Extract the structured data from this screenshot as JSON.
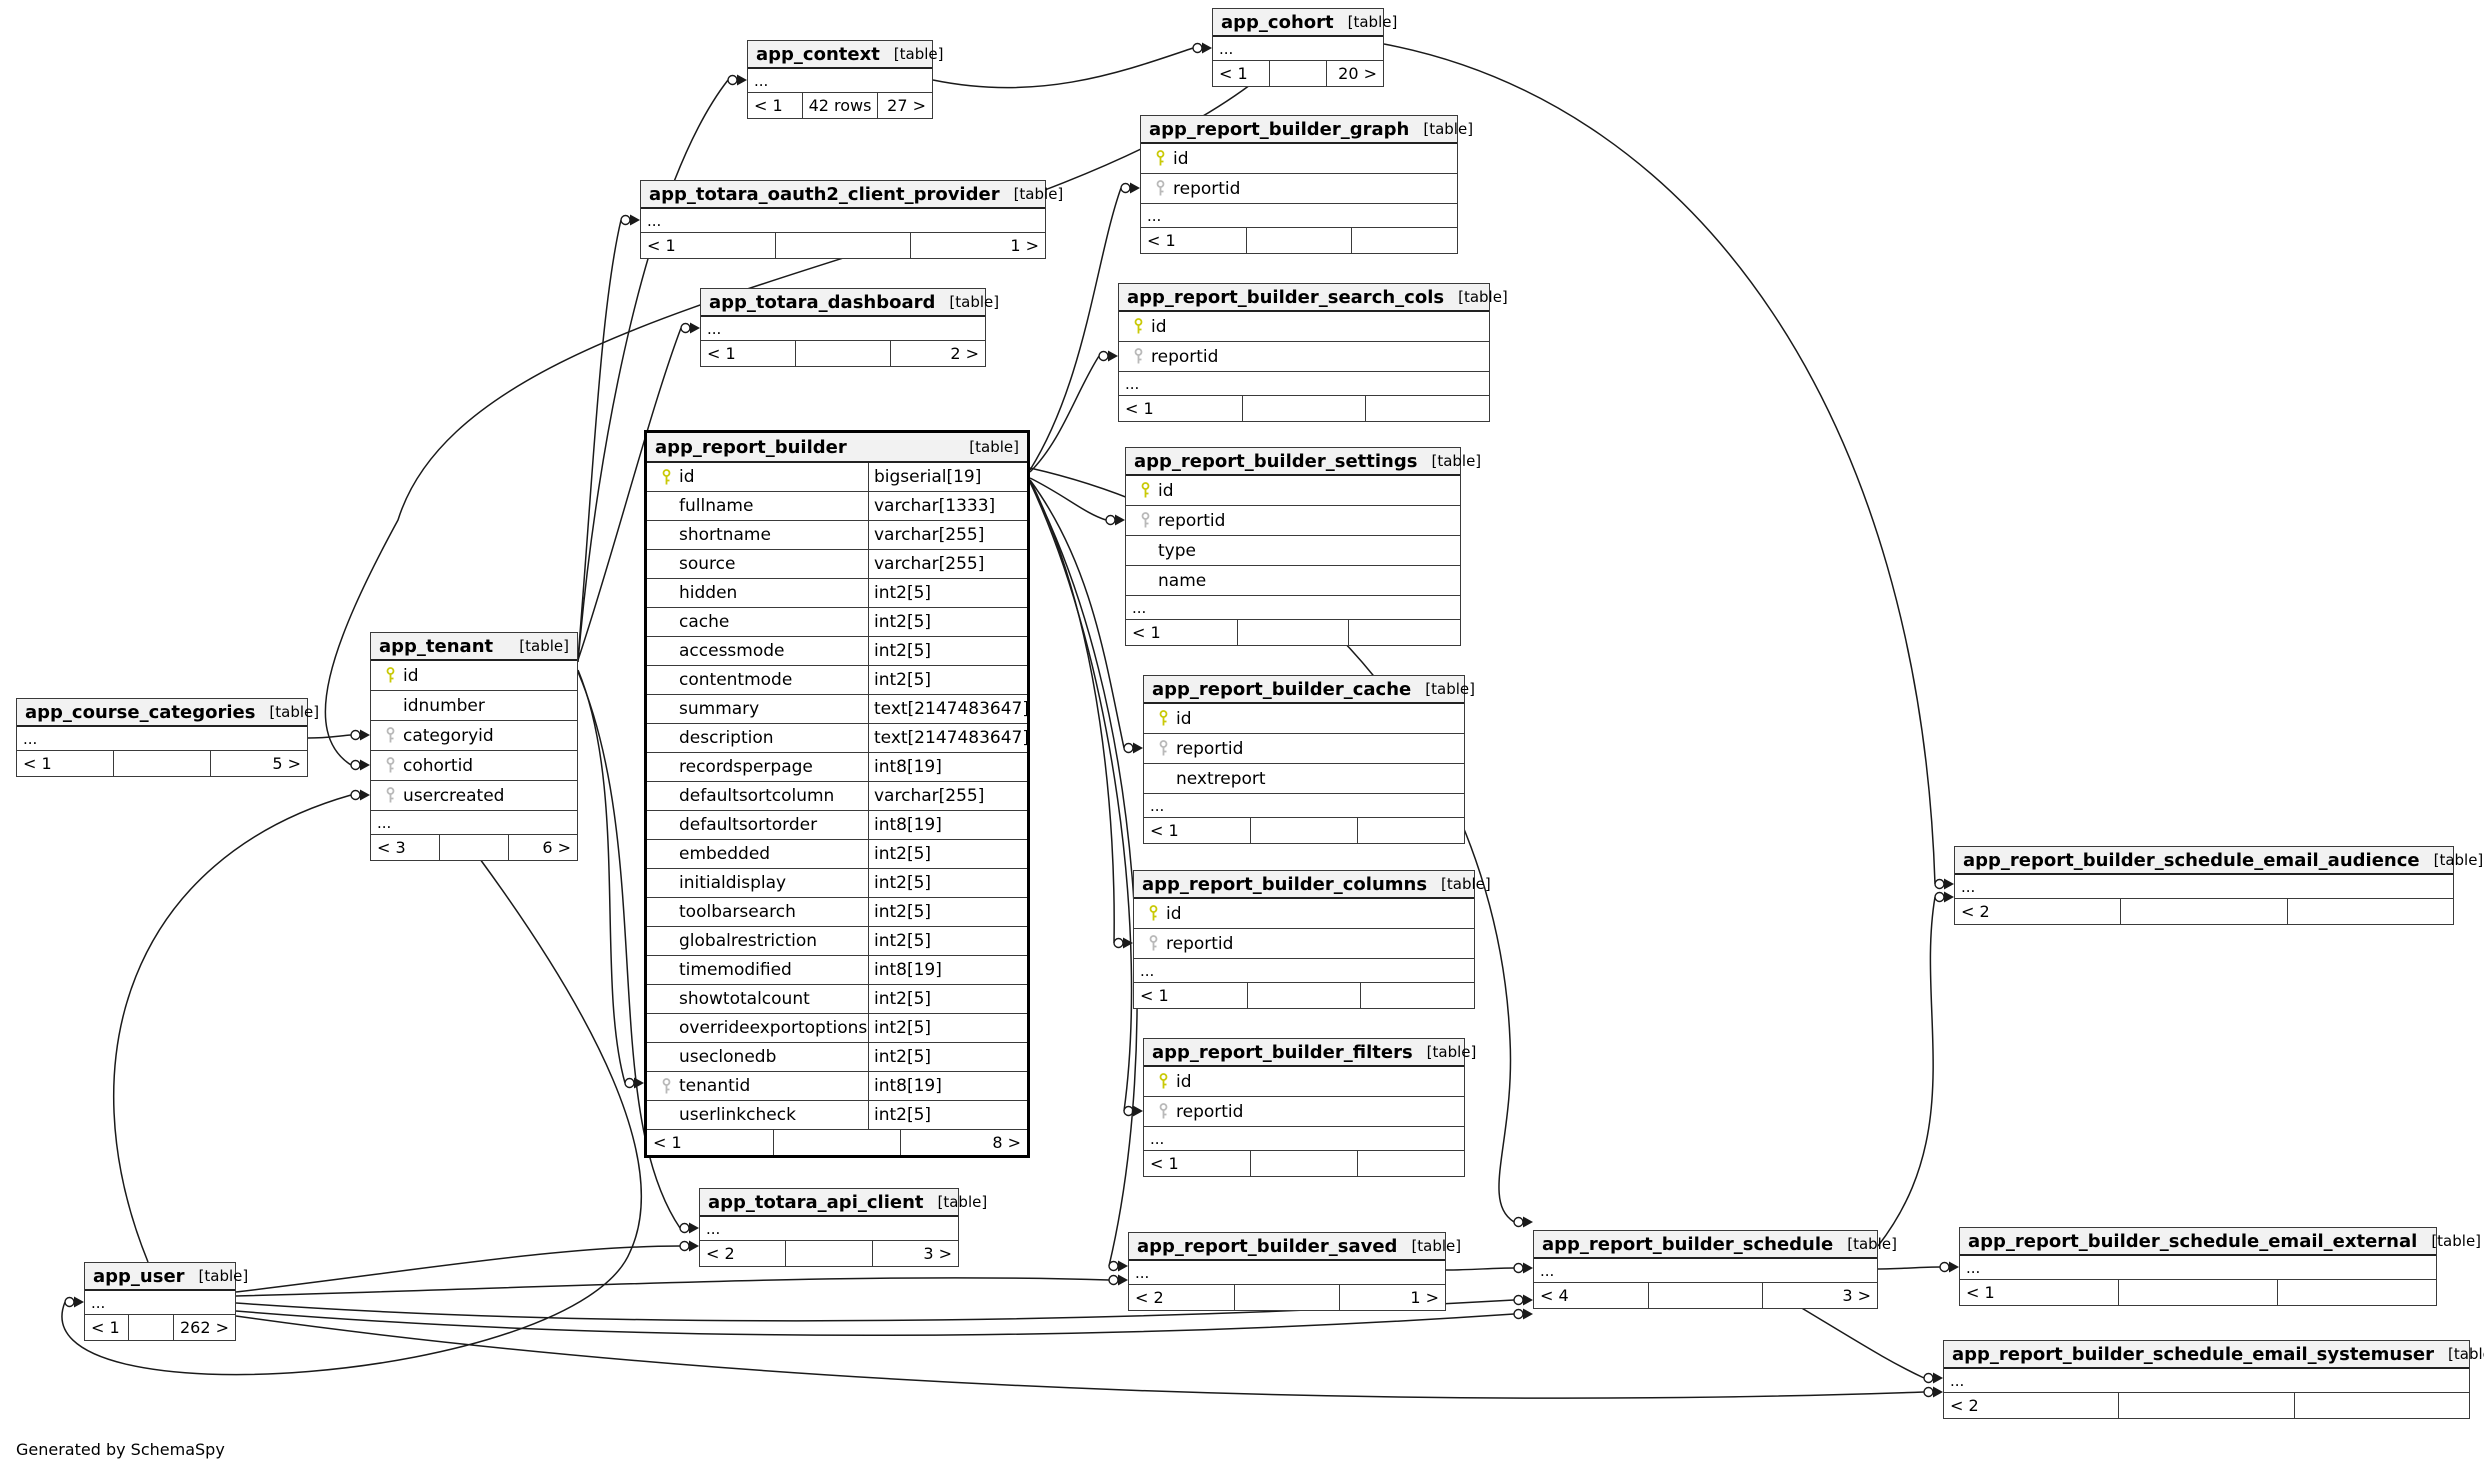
{
  "footer_note": "Generated by SchemaSpy",
  "labels": {
    "table_badge": "[table]",
    "ellipsis": "..."
  },
  "colors": {
    "pk_key": "#c9c907",
    "fk_key": "#b9b9b9",
    "edge": "#1a1a1a",
    "header_bg": "#f2f2f2",
    "border": "#3a3a3a"
  },
  "tables": [
    {
      "name": "app_context",
      "x": 747,
      "y": 40,
      "w": 186,
      "ellipsis": true,
      "footer": [
        "< 1",
        "42 rows",
        "27 >"
      ]
    },
    {
      "name": "app_cohort",
      "x": 1212,
      "y": 8,
      "w": 172,
      "ellipsis": true,
      "footer": [
        "< 1",
        "",
        "20 >"
      ]
    },
    {
      "name": "app_report_builder_graph",
      "x": 1140,
      "y": 115,
      "w": 318,
      "ellipsis": true,
      "columns": [
        {
          "n": "id",
          "k": "pk"
        },
        {
          "n": "reportid",
          "k": "fk"
        }
      ],
      "footer": [
        "< 1",
        "",
        ""
      ]
    },
    {
      "name": "app_totara_oauth2_client_provider",
      "x": 640,
      "y": 180,
      "w": 406,
      "ellipsis": true,
      "footer": [
        "< 1",
        "",
        "1 >"
      ]
    },
    {
      "name": "app_totara_dashboard",
      "x": 700,
      "y": 288,
      "w": 286,
      "ellipsis": true,
      "footer": [
        "< 1",
        "",
        "2 >"
      ]
    },
    {
      "name": "app_report_builder_search_cols",
      "x": 1118,
      "y": 283,
      "w": 372,
      "ellipsis": true,
      "columns": [
        {
          "n": "id",
          "k": "pk"
        },
        {
          "n": "reportid",
          "k": "fk"
        }
      ],
      "footer": [
        "< 1",
        "",
        ""
      ]
    },
    {
      "name": "app_report_builder",
      "x": 644,
      "y": 430,
      "w": 386,
      "main": true,
      "ellipsis": false,
      "columns": [
        {
          "n": "id",
          "t": "bigserial[19]",
          "k": "pk"
        },
        {
          "n": "fullname",
          "t": "varchar[1333]"
        },
        {
          "n": "shortname",
          "t": "varchar[255]"
        },
        {
          "n": "source",
          "t": "varchar[255]"
        },
        {
          "n": "hidden",
          "t": "int2[5]"
        },
        {
          "n": "cache",
          "t": "int2[5]"
        },
        {
          "n": "accessmode",
          "t": "int2[5]"
        },
        {
          "n": "contentmode",
          "t": "int2[5]"
        },
        {
          "n": "summary",
          "t": "text[2147483647]"
        },
        {
          "n": "description",
          "t": "text[2147483647]"
        },
        {
          "n": "recordsperpage",
          "t": "int8[19]"
        },
        {
          "n": "defaultsortcolumn",
          "t": "varchar[255]"
        },
        {
          "n": "defaultsortorder",
          "t": "int8[19]"
        },
        {
          "n": "embedded",
          "t": "int2[5]"
        },
        {
          "n": "initialdisplay",
          "t": "int2[5]"
        },
        {
          "n": "toolbarsearch",
          "t": "int2[5]"
        },
        {
          "n": "globalrestriction",
          "t": "int2[5]"
        },
        {
          "n": "timemodified",
          "t": "int8[19]"
        },
        {
          "n": "showtotalcount",
          "t": "int2[5]"
        },
        {
          "n": "overrideexportoptions",
          "t": "int2[5]"
        },
        {
          "n": "useclonedb",
          "t": "int2[5]"
        },
        {
          "n": "tenantid",
          "t": "int8[19]",
          "k": "fk"
        },
        {
          "n": "userlinkcheck",
          "t": "int2[5]"
        }
      ],
      "footer": [
        "< 1",
        "",
        "8 >"
      ]
    },
    {
      "name": "app_report_builder_settings",
      "x": 1125,
      "y": 447,
      "w": 336,
      "ellipsis": true,
      "columns": [
        {
          "n": "id",
          "k": "pk"
        },
        {
          "n": "reportid",
          "k": "fk"
        },
        {
          "n": "type"
        },
        {
          "n": "name"
        }
      ],
      "footer": [
        "< 1",
        "",
        ""
      ]
    },
    {
      "name": "app_report_builder_cache",
      "x": 1143,
      "y": 675,
      "w": 322,
      "ellipsis": true,
      "columns": [
        {
          "n": "id",
          "k": "pk"
        },
        {
          "n": "reportid",
          "k": "fk"
        },
        {
          "n": "nextreport"
        }
      ],
      "footer": [
        "< 1",
        "",
        ""
      ]
    },
    {
      "name": "app_report_builder_columns",
      "x": 1133,
      "y": 870,
      "w": 342,
      "ellipsis": true,
      "columns": [
        {
          "n": "id",
          "k": "pk"
        },
        {
          "n": "reportid",
          "k": "fk"
        }
      ],
      "footer": [
        "< 1",
        "",
        ""
      ]
    },
    {
      "name": "app_report_builder_filters",
      "x": 1143,
      "y": 1038,
      "w": 322,
      "ellipsis": true,
      "columns": [
        {
          "n": "id",
          "k": "pk"
        },
        {
          "n": "reportid",
          "k": "fk"
        }
      ],
      "footer": [
        "< 1",
        "",
        ""
      ]
    },
    {
      "name": "app_tenant",
      "x": 370,
      "y": 632,
      "w": 208,
      "ellipsis": true,
      "columns": [
        {
          "n": "id",
          "k": "pk"
        },
        {
          "n": "idnumber"
        },
        {
          "n": "categoryid",
          "k": "fk"
        },
        {
          "n": "cohortid",
          "k": "fk"
        },
        {
          "n": "usercreated",
          "k": "fk"
        }
      ],
      "footer": [
        "< 3",
        "",
        "6 >"
      ]
    },
    {
      "name": "app_course_categories",
      "x": 16,
      "y": 698,
      "w": 292,
      "ellipsis": true,
      "footer": [
        "< 1",
        "",
        "5 >"
      ]
    },
    {
      "name": "app_user",
      "x": 84,
      "y": 1262,
      "w": 152,
      "ellipsis": true,
      "footer": [
        "< 1",
        "",
        "262 >"
      ]
    },
    {
      "name": "app_totara_api_client",
      "x": 699,
      "y": 1188,
      "w": 260,
      "ellipsis": true,
      "footer": [
        "< 2",
        "",
        "3 >"
      ]
    },
    {
      "name": "app_report_builder_saved",
      "x": 1128,
      "y": 1232,
      "w": 318,
      "ellipsis": true,
      "footer": [
        "< 2",
        "",
        "1 >"
      ]
    },
    {
      "name": "app_report_builder_schedule",
      "x": 1533,
      "y": 1230,
      "w": 345,
      "ellipsis": true,
      "footer": [
        "< 4",
        "",
        "3 >"
      ]
    },
    {
      "name": "app_report_builder_schedule_email_audience",
      "x": 1954,
      "y": 846,
      "w": 500,
      "ellipsis": true,
      "footer": [
        "< 2",
        "",
        ""
      ]
    },
    {
      "name": "app_report_builder_schedule_email_external",
      "x": 1959,
      "y": 1227,
      "w": 478,
      "ellipsis": true,
      "footer": [
        "< 1",
        "",
        ""
      ]
    },
    {
      "name": "app_report_builder_schedule_email_systemuser",
      "x": 1943,
      "y": 1340,
      "w": 527,
      "ellipsis": true,
      "footer": [
        "< 2",
        "",
        ""
      ]
    }
  ],
  "edges": [
    {
      "from": "app_course_categories",
      "to": "app_tenant.categoryid",
      "tip": [
        370,
        735
      ],
      "d": "M308,738 C326,738 338,736 351,735"
    },
    {
      "from": "app_cohort",
      "to": "app_tenant.cohortid",
      "tip": [
        370,
        765
      ],
      "d": "M1250,85 C1000,270 470,290 398,520 C330,645 300,732 351,765"
    },
    {
      "from": "app_user",
      "to": "app_tenant.usercreated",
      "tip": [
        370,
        795
      ],
      "d": "M148,1262 C66,1060 130,858 351,795"
    },
    {
      "from": "app_tenant",
      "to": "app_context",
      "tip": [
        747,
        80
      ],
      "d": "M578,662 C598,430 650,180 728,80"
    },
    {
      "from": "app_context",
      "to": "app_cohort",
      "tip": [
        1212,
        48
      ],
      "d": "M933,80 C1040,102 1122,72 1193,48"
    },
    {
      "from": "app_tenant",
      "to": "app_totara_oauth2_client_provider",
      "tip": [
        640,
        220
      ],
      "d": "M578,658 C593,478 600,310 621,220"
    },
    {
      "from": "app_tenant",
      "to": "app_totara_dashboard",
      "tip": [
        700,
        328
      ],
      "d": "M578,660 C613,556 650,410 681,328"
    },
    {
      "from": "app_tenant",
      "to": "app_report_builder.tenantid",
      "tip": [
        644,
        1083
      ],
      "d": "M578,670 C628,790 596,980 625,1083"
    },
    {
      "from": "app_tenant",
      "to": "app_totara_api_client",
      "tip": [
        699,
        1228
      ],
      "d": "M578,672 C654,850 600,1110 680,1228"
    },
    {
      "from": "app_tenant",
      "to": "app_user",
      "tip": [
        84,
        1302
      ],
      "d": "M480,859 C592,1012 672,1162 630,1252 C576,1382 16,1424 65,1302"
    },
    {
      "from": "app_report_builder",
      "to": "app_report_builder_graph.reportid",
      "tip": [
        1140,
        188
      ],
      "d": "M1030,470 C1086,380 1096,258 1121,188"
    },
    {
      "from": "app_report_builder",
      "to": "app_report_builder_search_cols.reportid",
      "tip": [
        1118,
        356
      ],
      "d": "M1030,472 C1062,440 1076,392 1099,356"
    },
    {
      "from": "app_report_builder",
      "to": "app_report_builder_settings.reportid",
      "tip": [
        1125,
        520
      ],
      "d": "M1030,478 C1066,496 1084,513 1106,520"
    },
    {
      "from": "app_report_builder",
      "to": "app_report_builder_cache.reportid",
      "tip": [
        1143,
        748
      ],
      "d": "M1030,480 C1092,564 1106,664 1124,748"
    },
    {
      "from": "app_report_builder",
      "to": "app_report_builder_columns.reportid",
      "tip": [
        1133,
        943
      ],
      "d": "M1030,480 C1102,624 1116,826 1114,943"
    },
    {
      "from": "app_report_builder",
      "to": "app_report_builder_filters.reportid",
      "tip": [
        1143,
        1111
      ],
      "d": "M1030,482 C1114,662 1148,936 1124,1111"
    },
    {
      "from": "app_report_builder",
      "to": "app_report_builder_saved",
      "tip": [
        1128,
        1266
      ],
      "d": "M1030,482 C1146,706 1160,1050 1109,1266"
    },
    {
      "from": "app_report_builder",
      "to": "app_report_builder_schedule",
      "tip": [
        1533,
        1222
      ],
      "d": "M1030,468 C1348,540 1500,800 1510,1040 C1515,1140 1480,1200 1514,1222"
    },
    {
      "from": "app_user",
      "to": "app_report_builder_saved",
      "tip": [
        1128,
        1280
      ],
      "d": "M236,1296 C548,1288 848,1272 1109,1280"
    },
    {
      "from": "app_report_builder_saved",
      "to": "app_report_builder_schedule",
      "tip": [
        1533,
        1268
      ],
      "d": "M1446,1270 C1472,1270 1492,1268 1514,1268"
    },
    {
      "from": "app_user",
      "to": "app_report_builder_schedule",
      "tip": [
        1533,
        1300
      ],
      "d": "M236,1303 C700,1336 1230,1316 1514,1300"
    },
    {
      "from": "app_user",
      "to": "app_report_builder_schedule",
      "tip": [
        1533,
        1314
      ],
      "d": "M236,1311 C760,1354 1280,1330 1514,1314"
    },
    {
      "from": "app_user",
      "to": "app_totara_api_client",
      "tip": [
        699,
        1246
      ],
      "d": "M236,1292 C420,1270 560,1246 680,1246"
    },
    {
      "from": "app_cohort",
      "to": "app_report_builder_schedule_email_audience",
      "tip": [
        1954,
        884
      ],
      "d": "M1384,44 C1700,104 1920,420 1935,884"
    },
    {
      "from": "app_report_builder_schedule",
      "to": "app_report_builder_schedule_email_audience",
      "tip": [
        1954,
        897
      ],
      "d": "M1878,1246 C1968,1130 1916,1010 1935,897"
    },
    {
      "from": "app_report_builder_schedule",
      "to": "app_report_builder_schedule_email_external",
      "tip": [
        1959,
        1267
      ],
      "d": "M1878,1269 C1900,1269 1920,1267 1940,1267"
    },
    {
      "from": "app_report_builder_schedule",
      "to": "app_report_builder_schedule_email_systemuser",
      "tip": [
        1943,
        1378
      ],
      "d": "M1800,1307 C1868,1348 1890,1362 1924,1378"
    },
    {
      "from": "app_user",
      "to": "app_report_builder_schedule_email_systemuser",
      "tip": [
        1943,
        1392
      ],
      "d": "M236,1316 C800,1396 1480,1408 1924,1392"
    }
  ]
}
